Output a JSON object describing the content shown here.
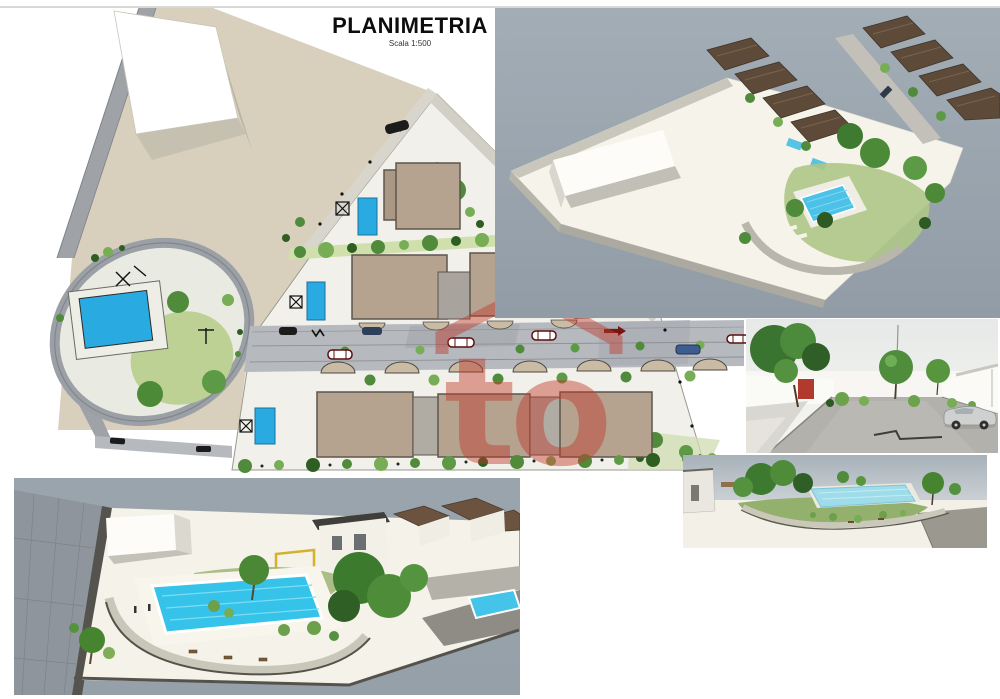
{
  "document": {
    "title": "PLANIMETRIA",
    "scale_label": "Scala 1:500"
  },
  "watermark": {
    "letters": "to",
    "color": "#c23a2c"
  },
  "palette": {
    "terrain_beige": "#d8d0bc",
    "parcel_white": "#f2f0ea",
    "road_gray": "#b6b9be",
    "pool_blue": "#29abe2",
    "building_tan": "#b5a38f",
    "tree_green": "#4f8b3a",
    "render_sky": "#9aa5ae",
    "watermark_red": "#c23a2c"
  },
  "panels": {
    "site_plan": {
      "name": "site-plan-2d"
    },
    "aerial_view": {
      "name": "aerial-3d-render"
    },
    "street_view": {
      "name": "street-level-3d-render"
    },
    "pool_garden_view": {
      "name": "pool-garden-3d-render"
    },
    "pool_main_view": {
      "name": "main-pool-3d-render"
    }
  }
}
